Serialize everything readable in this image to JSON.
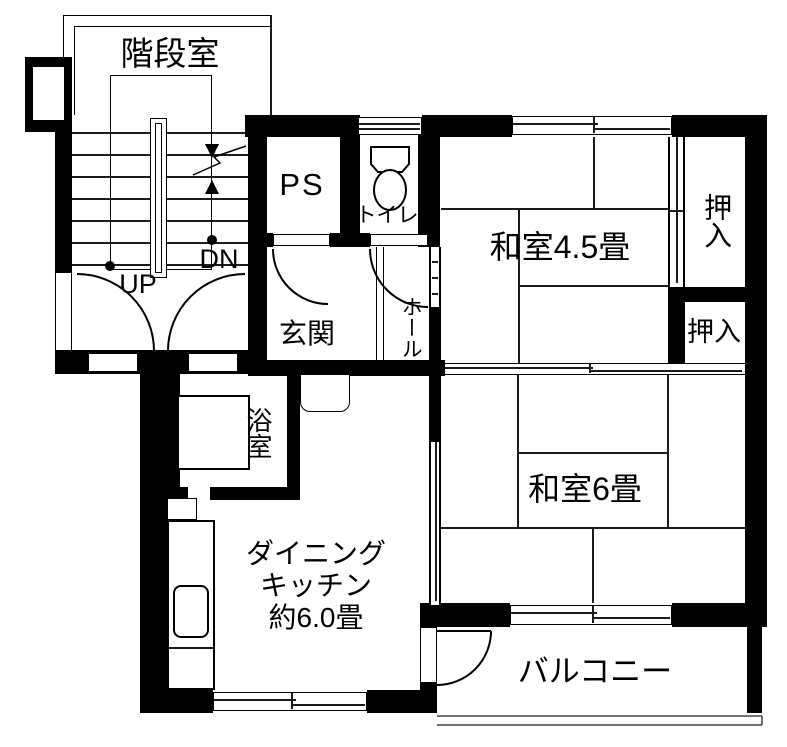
{
  "plan_title": "apartment floor plan",
  "rooms": {
    "stairwell": {
      "label": "階段室"
    },
    "ps": {
      "label": "PS"
    },
    "toilet": {
      "label": "トイレ"
    },
    "genkan": {
      "label": "玄関"
    },
    "hall": {
      "label": "ホール"
    },
    "washitsu45": {
      "label": "和室4.5畳"
    },
    "oshiire_upper": {
      "label": "押入"
    },
    "oshiire_lower": {
      "label": "押入"
    },
    "washitsu6": {
      "label": "和室6畳"
    },
    "bathroom": {
      "label": "浴室"
    },
    "dining_kitchen": {
      "line1": "ダイニング",
      "line2": "キッチン",
      "line3": "約6.0畳"
    },
    "balcony": {
      "label": "バルコニー"
    }
  },
  "stairs": {
    "up_label": "UP",
    "dn_label": "DN"
  },
  "colors": {
    "wall": "#000000",
    "background": "#ffffff",
    "thin_line": "#1c1c1c"
  }
}
